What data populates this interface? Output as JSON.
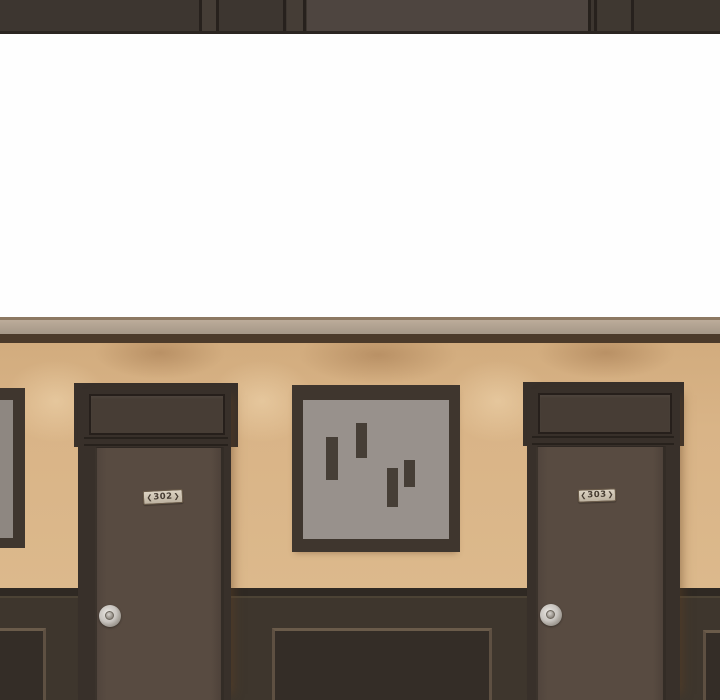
{
  "palette": {
    "ceiling-dark": "#3d3630",
    "ceiling-mid": "#453d36",
    "ceiling-light": "#4e4540",
    "ceiling-seam": "#27211d",
    "upper-wall": "#fefefe",
    "molding-edge": "#8c7862",
    "molding-dark": "#4b3a2a",
    "wall-tan": "#d9b487",
    "casing-dark": "#38302a",
    "transom-panel": "#473d35",
    "door-slab": "#584b41",
    "slab-edge": "#2e2722",
    "wainscot": "#3e362d",
    "wainscot-top": "#2f2923",
    "wainscot-line": "#4c4335",
    "panel-face": "#342d27",
    "panel-border": "#5e5042",
    "art-frame": "#3f362e",
    "art-canvas": "#98918c",
    "art-bar": "#463e36",
    "plate-text": "#453b31",
    "knob-metal": "#c9c5c0"
  },
  "scene": {
    "doors": [
      {
        "name": "door-302",
        "plate_number": "302",
        "chevron_left": "❮",
        "chevron_right": "❯"
      },
      {
        "name": "door-303",
        "plate_number": "303",
        "chevron_left": "❮",
        "chevron_right": "❯"
      }
    ]
  }
}
